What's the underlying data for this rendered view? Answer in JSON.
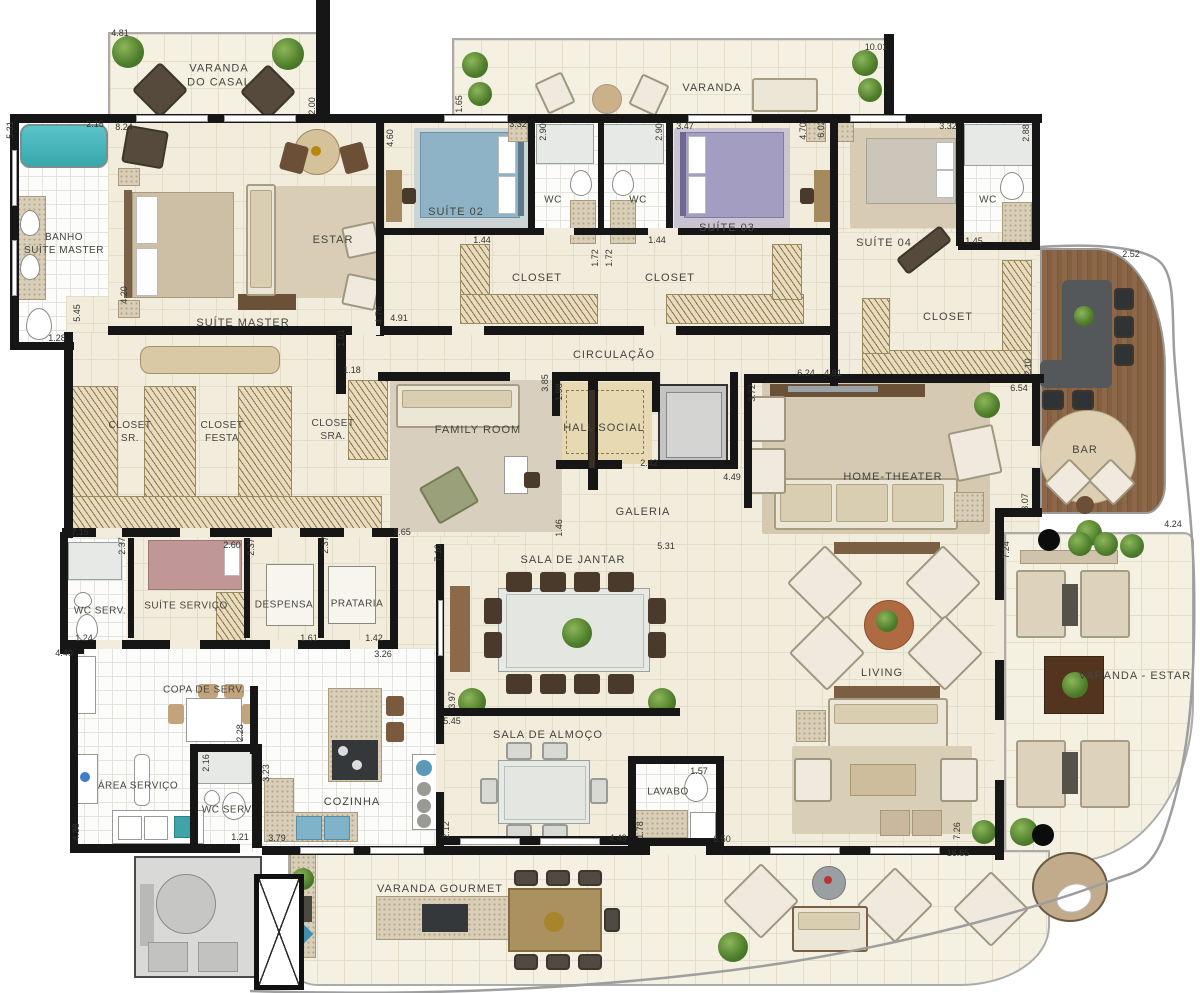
{
  "rooms": {
    "varanda_casal": "VARANDA\nDO CASAL",
    "banho": "BANHO\nSUÍTE MASTER",
    "suite_master": "SUÍTE MASTER",
    "estar": "ESTAR",
    "varanda": "VARANDA",
    "suite02": "SUÍTE 02",
    "wc_a": "WC",
    "wc_b": "WC",
    "suite03": "SUÍTE 03",
    "suite04": "SUÍTE 04",
    "wc04": "WC",
    "closet02": "CLOSET",
    "closet03": "CLOSET",
    "closet04": "CLOSET",
    "circulacao": "CIRCULAÇÃO",
    "closet_sr": "CLOSET\nSR.",
    "closet_festa": "CLOSET\nFESTA",
    "closet_sra": "CLOSET\nSRA.",
    "family": "FAMILY ROOM",
    "hall": "HALL SOCIAL",
    "galeria": "GALERIA",
    "home_theater": "HOME-THEATER",
    "bar": "BAR",
    "wc_serv1": "WC SERV.",
    "suite_servico": "SUÍTE SERVIÇO",
    "despensa": "DESPENSA",
    "prataria": "PRATARIA",
    "jantar": "SALA DE JANTAR",
    "copa": "COPA DE SERV.",
    "area_servico": "ÁREA SERVIÇO",
    "wc_serv2": "WC SERV.",
    "cozinha": "COZINHA",
    "almoco": "SALA DE ALMOÇO",
    "lavabo": "LAVABO",
    "living": "LIVING",
    "varanda_estar": "VARANDA - ESTAR",
    "gourmet": "VARANDA GOURMET"
  },
  "dims": [
    "4.81",
    "5.31",
    "2.15",
    "8.24",
    "2.00",
    "4.60",
    "1.65",
    "2.90",
    "2.90",
    "3.32",
    "3.47",
    "4.70",
    "6.02",
    "3.32",
    "2.88",
    "10.01",
    "1.44",
    "1.44",
    "1.72",
    "1.72",
    "1.45",
    "4.91",
    "5.45",
    "1.28",
    "4.20",
    "4.76",
    "1.01",
    "1.18",
    "3.85",
    "1.98",
    "2.42",
    "4.49",
    "6.24",
    "4.91",
    "2.10",
    "6.54",
    "3.07",
    "4.24",
    "2.52",
    "7.15",
    "3.65",
    "1.46",
    "5.31",
    "7.10",
    "3.72",
    "7.24",
    "2.37",
    "2.60",
    "2.37",
    "2.37",
    "1.61",
    "1.42",
    "3.26",
    "4.40",
    "1.24",
    "2.16",
    "2.28",
    "3.23",
    "4.88",
    "1.21",
    "3.79",
    "2.12",
    "3.97",
    "5.45",
    "4.49",
    "1.57",
    "1.78",
    "6.50",
    "16.65",
    "7.26"
  ],
  "colors": {
    "wall": "#161616",
    "floor": "#f1ecdb",
    "balcony_floor": "#f4f0e2",
    "deck_wood": "#7b573c",
    "bathtub": "#45b6bb",
    "bed_suite02": "#8fb3c6",
    "bed_suite03": "#a39dc2",
    "bed_suite04": "#ccc6ba",
    "living_rug": "#b06a42"
  }
}
